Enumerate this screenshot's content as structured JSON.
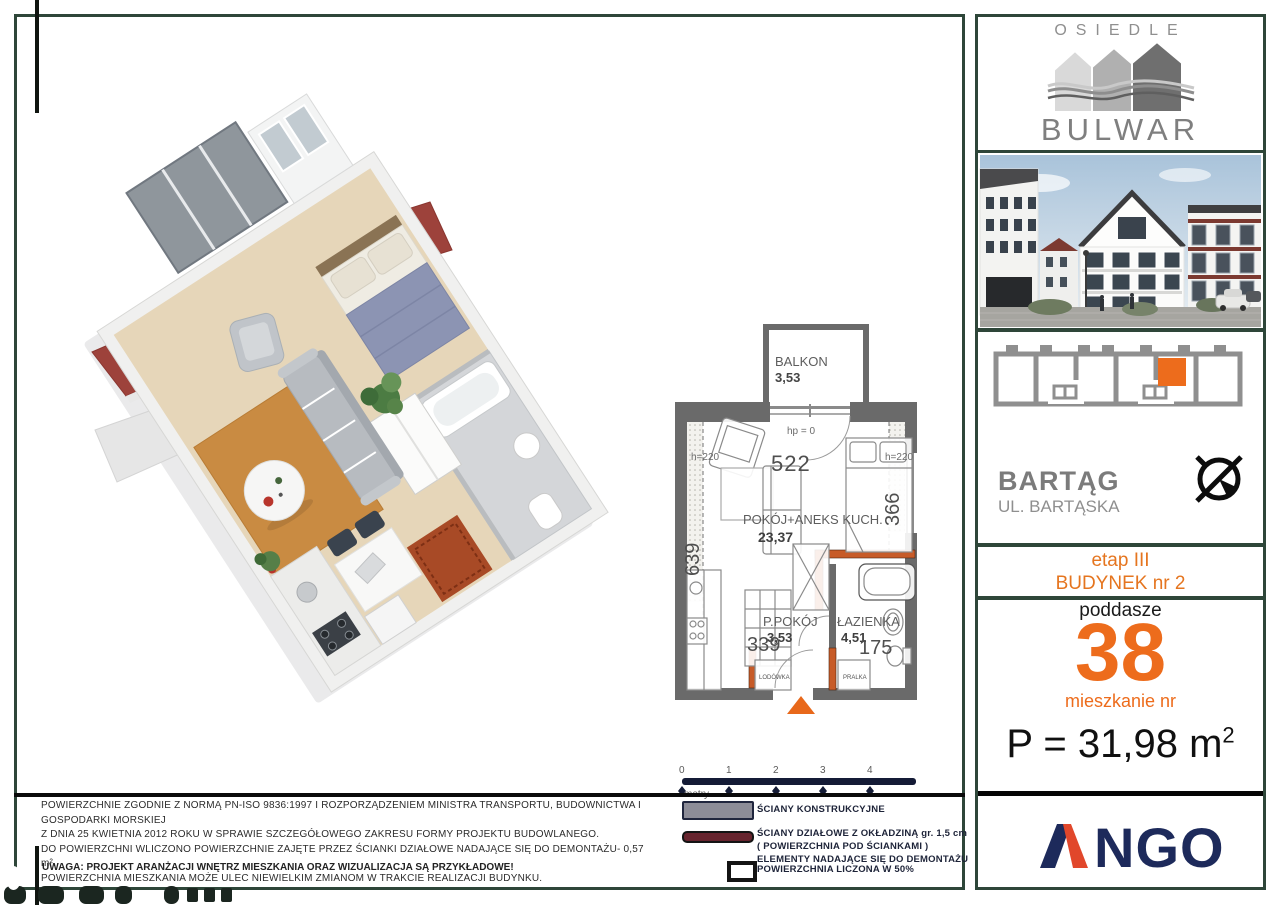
{
  "brand": {
    "top": "OSIEDLE",
    "name": "BULWAR"
  },
  "location": {
    "name": "BARTĄG",
    "street": "UL. BARTĄSKA"
  },
  "stage": {
    "etap": "etap III",
    "building": "BUDYNEK nr 2"
  },
  "unit": {
    "floor": "poddasze",
    "number": "38",
    "number_caption": "mieszkanie nr",
    "area_prefix": "P = 31,98 m",
    "area_sup": "2"
  },
  "developer": {
    "name": "NGO"
  },
  "plan": {
    "balcony": {
      "label": "BALKON",
      "area": "3,53"
    },
    "main_room": {
      "label": "POKÓJ+ANEKS KUCH.",
      "area": "23,37"
    },
    "hall": {
      "label": "P.POKÓJ",
      "area": "3,53"
    },
    "bath": {
      "label": "ŁAZIENKA",
      "area": "4,51"
    },
    "dims": {
      "width": "522",
      "bed_width": "366",
      "length": "639",
      "kitchen_width": "339",
      "bath_width": "175"
    },
    "annotations": {
      "parapet": "hp = 0",
      "height_left": "h=220",
      "height_right": "h=220"
    },
    "appliances": {
      "fridge": "LODÓWKA",
      "washer": "PRALKA"
    }
  },
  "scale_bar": {
    "ticks": [
      "0",
      "1",
      "2",
      "3",
      "4"
    ],
    "unit_label": "metry"
  },
  "legend": {
    "structural": "ŚCIANY KONSTRUKCYJNE",
    "partition_line1": "ŚCIANY DZIAŁOWE Z OKŁADZINĄ gr. 1,5 cm",
    "partition_line2": "( POWIERZCHNIA POD ŚCIANKAMI )",
    "partition_line3": "ELEMENTY NADAJĄCE  SIĘ DO DEMONTAŻU",
    "half_area": "POWIERZCHNIA LICZONA W 50%"
  },
  "disclaimer": {
    "line1": "POWIERZCHNIE ZGODNIE Z NORMĄ PN-ISO 9836:1997 I ROZPORZĄDZENIEM  MINISTRA TRANSPORTU, BUDOWNICTWA I GOSPODARKI MORSKIEJ",
    "line2": "Z DNIA 25 KWIETNIA 2012 ROKU  W SPRAWIE SZCZEGÓŁOWEGO ZAKRESU FORMY PROJEKTU BUDOWLANEGO.",
    "line3": "DO POWIERZCHNI WLICZONO POWIERZCHNIE ZAJĘTE PRZEZ ŚCIANKI DZIAŁOWE NADAJĄCE SIĘ DO DEMONTAŻU- 0,57 m².",
    "line4": "POWIERZCHNIA MIESZKANIA MOŻE ULEC NIEWIELKIM ZMIANOM W TRAKCIE REALIZACJI BUDYNKU.",
    "note": "UWAGA: PROJEKT  ARANŻACJI WNĘTRZ MIESZKANIA ORAZ WIZUALIZACJA SĄ PRZYKŁADOWE!"
  },
  "colors": {
    "accent": "#ED6C1C",
    "frame": "#2E4639",
    "navy": "#1D2A5B",
    "ango_red": "#E1472B",
    "wall_gray": "#6A6A6A",
    "partition_maroon": "#67242E"
  }
}
